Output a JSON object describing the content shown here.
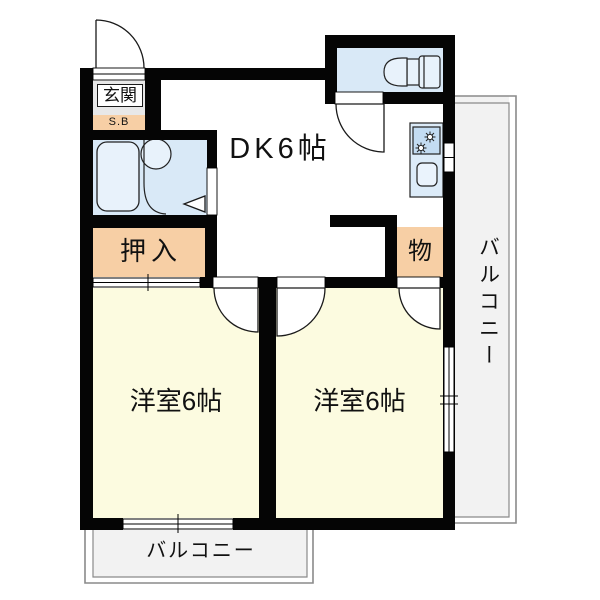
{
  "floorplan": {
    "rooms": {
      "entrance": {
        "label": "玄関"
      },
      "shoe_box": {
        "label": "S.B"
      },
      "dining_kitchen": {
        "label": "DK6帖"
      },
      "closet": {
        "label": "押入"
      },
      "storage": {
        "label": "物"
      },
      "western_room_left": {
        "label": "洋室6帖"
      },
      "western_room_right": {
        "label": "洋室6帖"
      },
      "balcony_right": {
        "label": "バルコニー"
      },
      "balcony_bottom": {
        "label": "バルコニー"
      }
    },
    "colors": {
      "wall": "#000000",
      "room_cream": "#fcfbe0",
      "closet_peach": "#f7cfa5",
      "wet_area_blue": "#d9e9f7",
      "fixture_blue": "#e8f2fb",
      "stove_blue": "#c3dcf2",
      "balcony_gray": "#f2f2f2",
      "entrance_gray": "#e8e8e8",
      "balcony_border": "#8a8a8a"
    },
    "icons": {
      "bathtub": "bathtub-icon",
      "washbasin": "washbasin-icon",
      "toilet": "toilet-icon",
      "stove": "stove-icon",
      "sink": "sink-icon",
      "door_swing": "door-swing-icon",
      "sliding_door": "sliding-door-icon",
      "window": "window-icon"
    }
  }
}
